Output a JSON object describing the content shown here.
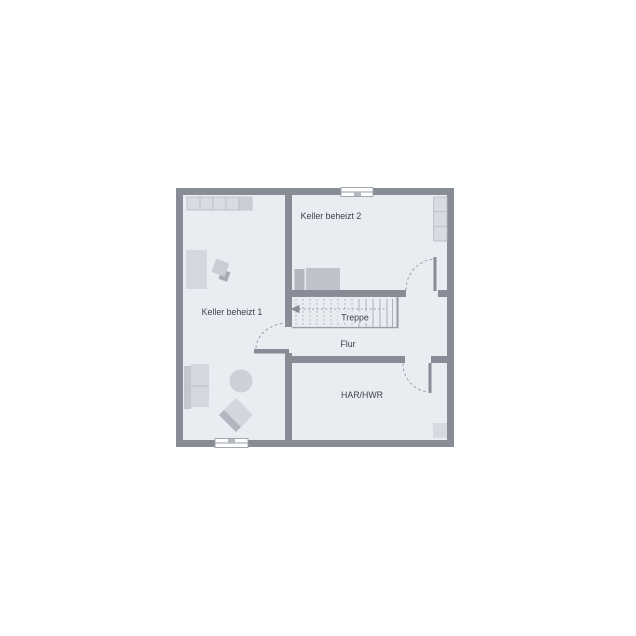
{
  "floorplan": {
    "type": "basement-floor-plan",
    "rooms": [
      {
        "id": "keller1",
        "label": "Keller beheizt 1"
      },
      {
        "id": "keller2",
        "label": "Keller beheizt 2"
      },
      {
        "id": "treppe",
        "label": "Treppe"
      },
      {
        "id": "flur",
        "label": "Flur"
      },
      {
        "id": "har_hwr",
        "label": "HAR/HWR"
      }
    ],
    "colors": {
      "wall": "#878c96",
      "floor": "#e9ecf1",
      "background": "#ffffff",
      "thin_line": "#9aa0a9",
      "furniture_light": "#d8dbe2",
      "furniture_mid": "#bec3cb",
      "furniture_dark": "#b1b6bf",
      "label_text": "#3e434e"
    }
  }
}
